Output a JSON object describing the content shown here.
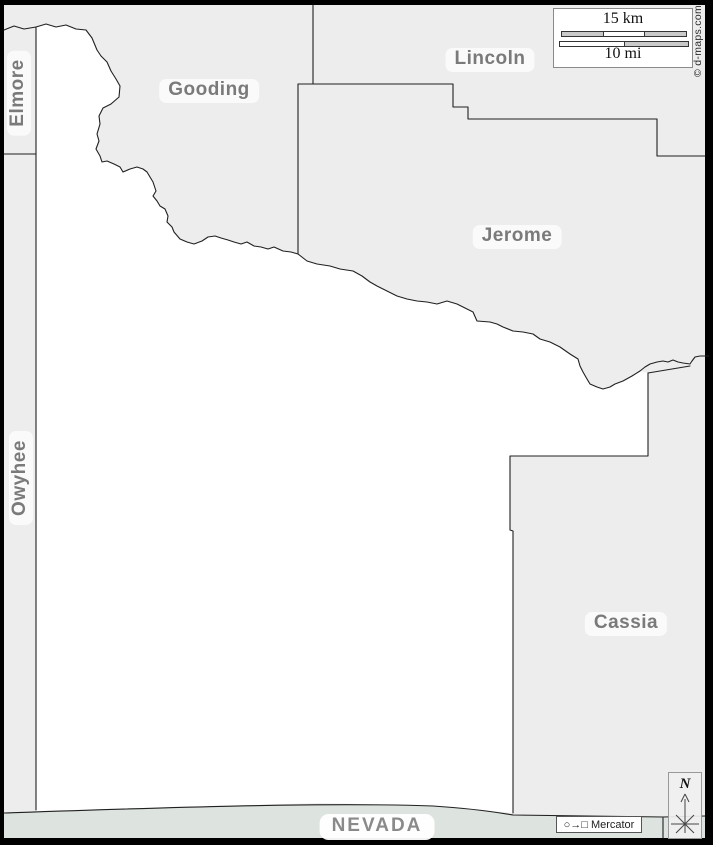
{
  "labels": {
    "gooding": "Gooding",
    "lincoln": "Lincoln",
    "jerome": "Jerome",
    "cassia": "Cassia",
    "elmore": "Elmore",
    "owyhee": "Owyhee",
    "nevada": "NEVADA"
  },
  "scale": {
    "km": "15 km",
    "mi": "10 mi"
  },
  "copyright": "© d-maps.com",
  "projection": {
    "symbols": "○→□",
    "name": "Mercator"
  },
  "compass": {
    "north": "N"
  },
  "colors": {
    "neighbor_fill": "#ededed",
    "highlight_fill": "#ffffff",
    "nevada_fill": "#dde3de",
    "boundary_line": "#202020",
    "frame": "#000000",
    "label_text": "#7a7a7a"
  }
}
